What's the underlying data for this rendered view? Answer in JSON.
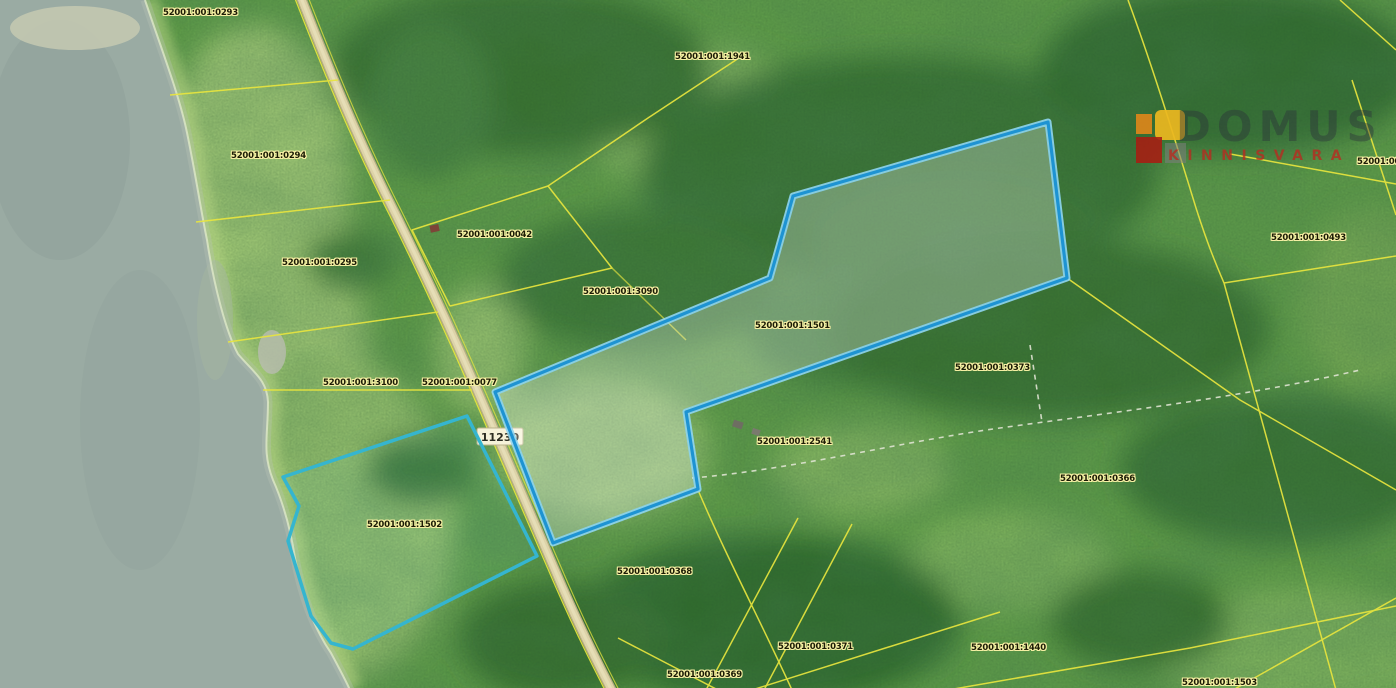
{
  "map": {
    "road_sign": "11230",
    "highlighted_parcel_code": "52001:001:1501",
    "secondary_parcel_code": "52001:001:1502",
    "parcels": [
      {
        "code": "52001:001:0293",
        "x": 163,
        "y": 8
      },
      {
        "code": "52001:001:1941",
        "x": 675,
        "y": 52
      },
      {
        "code": "52001:001:0294",
        "x": 231,
        "y": 151
      },
      {
        "code": "52001:001:0042",
        "x": 457,
        "y": 230
      },
      {
        "code": "52001:001:0295",
        "x": 282,
        "y": 258
      },
      {
        "code": "52001:001:3090",
        "x": 583,
        "y": 287
      },
      {
        "code": "52001:001:1501",
        "x": 755,
        "y": 321
      },
      {
        "code": "52001:00",
        "x": 1357,
        "y": 157
      },
      {
        "code": "52001:001:0493",
        "x": 1271,
        "y": 233
      },
      {
        "code": "52001:001:3100",
        "x": 323,
        "y": 378
      },
      {
        "code": "52001:001:0077",
        "x": 422,
        "y": 378
      },
      {
        "code": "52001:001:0373",
        "x": 955,
        "y": 363
      },
      {
        "code": "52001:001:2541",
        "x": 757,
        "y": 437
      },
      {
        "code": "52001:001:0366",
        "x": 1060,
        "y": 474
      },
      {
        "code": "52001:001:1502",
        "x": 367,
        "y": 520
      },
      {
        "code": "52001:001:0368",
        "x": 617,
        "y": 567
      },
      {
        "code": "52001:001:0371",
        "x": 778,
        "y": 642
      },
      {
        "code": "52001:001:1440",
        "x": 971,
        "y": 643
      },
      {
        "code": "52001:001:0369",
        "x": 667,
        "y": 670
      },
      {
        "code": "52001:001:1503",
        "x": 1182,
        "y": 678
      }
    ]
  },
  "watermark": {
    "name": "DOMUS",
    "subtitle": "KINNISVARA"
  },
  "colors": {
    "cadastral_line": "#e8e53e",
    "highlight_blue": "#1e93d2",
    "secondary_teal": "#35b5cf",
    "label_text": "#1b1b05",
    "label_halo": "#f5efa3",
    "water": "#9aaba3",
    "brand_red": "#b92a20"
  }
}
